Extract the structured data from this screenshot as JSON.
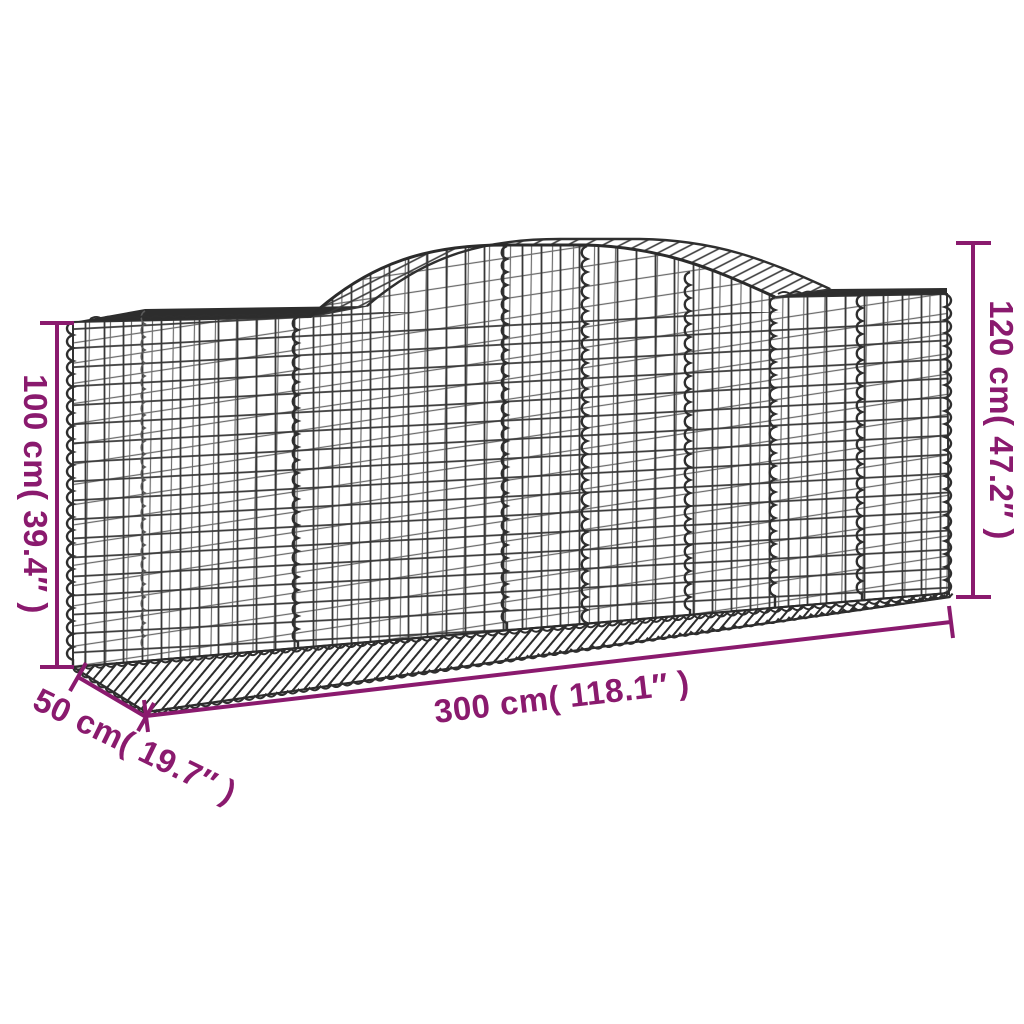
{
  "colors": {
    "annotation": "#8A1A6E",
    "wire": "#3A3A3A",
    "background": "#FFFFFF"
  },
  "dimension_labels": {
    "side_height": "100 cm( 39.4″ )",
    "total_height": "120 cm( 47.2″ )",
    "length": "300 cm( 118.1″ )",
    "depth": "50 cm( 19.7″ )"
  }
}
